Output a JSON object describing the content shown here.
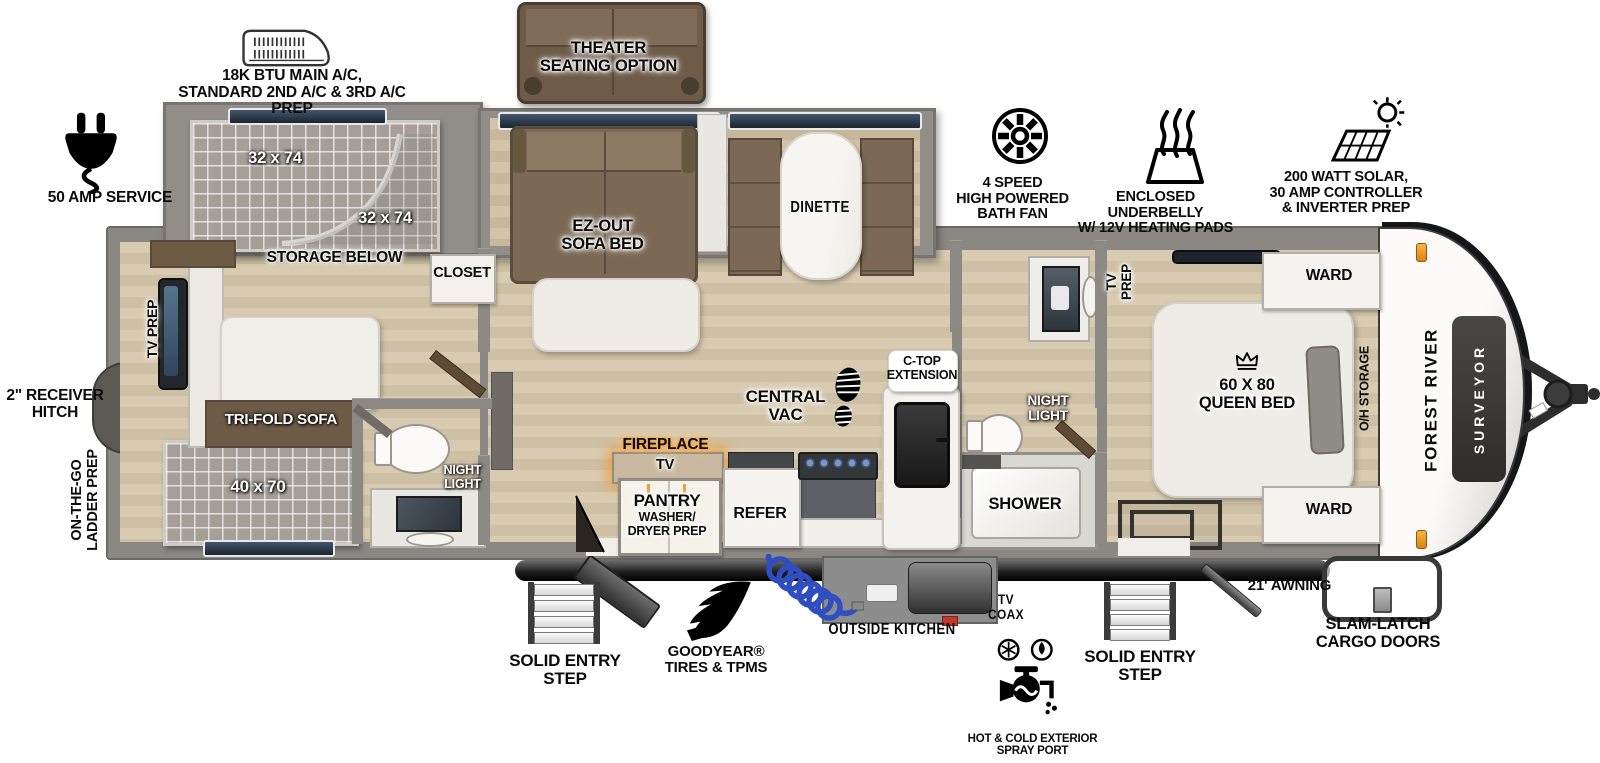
{
  "colors": {
    "fireplace_glow": "#f7941d",
    "hose_blue": "#3a56c2",
    "amber_marker": "#f0a11c"
  },
  "exterior": {
    "ac_note": "18K BTU MAIN A/C,\nSTANDARD 2ND A/C & 3RD A/C PREP",
    "service_50amp": "50 AMP SERVICE",
    "bath_fan": "4 SPEED\nHIGH POWERED\nBATH FAN",
    "underbelly": "ENCLOSED UNDERBELLY\nW/ 12V HEATING PADS",
    "solar": "200 WATT SOLAR,\n30 AMP CONTROLLER\n& INVERTER PREP",
    "receiver_hitch": "2\" RECEIVER\nHITCH",
    "ladder_prep": "ON-THE-GO\nLADDER PREP",
    "entry_step_left": "SOLID ENTRY\nSTEP",
    "goodyear": "GOODYEAR®\nTIRES & TPMS",
    "outside_kitchen": "OUTSIDE KITCHEN",
    "tv_coax": "TV\nCOAX",
    "spray_port": "HOT & COLD EXTERIOR\nSPRAY PORT",
    "entry_step_right": "SOLID ENTRY\nSTEP",
    "awning": "21' AWNING",
    "slam_latch": "SLAM-LATCH\nCARGO DOORS"
  },
  "interior": {
    "theater_option": "THEATER\nSEATING OPTION",
    "bunk_upper": "32 x 74",
    "bunk_lower": "32 x 74",
    "storage_below": "STORAGE BELOW",
    "closet": "CLOSET",
    "tv_prep_rear": "TV PREP",
    "tri_fold_sofa": "TRI-FOLD SOFA",
    "rear_bunk": "40 x 70",
    "night_light_rear": "NIGHT\nLIGHT",
    "ez_out_sofa_bed": "EZ-OUT\nSOFA BED",
    "dinette": "DINETTE",
    "central_vac": "CENTRAL\nVAC",
    "ctop_extension": "C-TOP\nEXTENSION",
    "fireplace": "FIREPLACE",
    "tv": "TV",
    "pantry": "PANTRY",
    "pantry_sub": "WASHER/\nDRYER PREP",
    "refer": "REFER",
    "night_light_mid": "NIGHT\nLIGHT",
    "shower": "SHOWER",
    "tv_prep_bedroom": "TV\nPREP",
    "queen_bed": "60 X 80\nQUEEN BED",
    "oh_storage": "O/H STORAGE",
    "ward_top": "WARD",
    "ward_bottom": "WARD"
  },
  "brand": {
    "manufacturer": "FOREST RIVER",
    "model": "SURVEYOR"
  }
}
